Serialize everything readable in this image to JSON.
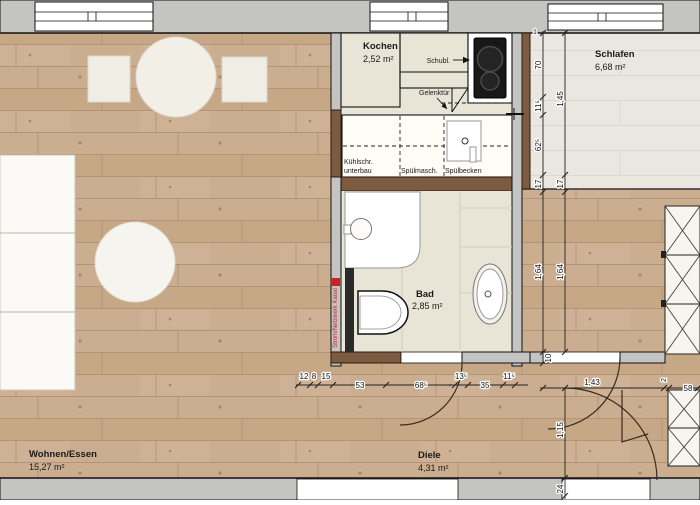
{
  "rooms": {
    "kochen": {
      "name": "Kochen",
      "area": "2,52 m²"
    },
    "schlafen": {
      "name": "Schlafen",
      "area": "6,68 m²"
    },
    "bad": {
      "name": "Bad",
      "area": "2,85 m²"
    },
    "wohnen": {
      "name": "Wohnen/Essen",
      "area": "15,27 m²"
    },
    "diele": {
      "name": "Diele",
      "area": "4,31 m²"
    }
  },
  "kitchen": {
    "schubl": "Schubl.",
    "gelenktuer": "Gelenktür",
    "kuehlschr1": "Kühlschr.",
    "kuehlschr2": "unterbau",
    "spuelmasch": "Spülmasch.",
    "spuelbecken": "Spülbecken"
  },
  "annotations": {
    "kanal": "Strom/Netzwerk Kanal"
  },
  "dims": {
    "bottom": [
      "12",
      "8",
      "15",
      "53",
      "68⁵",
      "13⁵",
      "35",
      "11⁵"
    ],
    "colA": [
      "1",
      "70",
      "11⁵",
      "62⁵",
      "17",
      "1,64",
      "10"
    ],
    "colB": [
      "1,45",
      "17",
      "1,64",
      "1,15",
      "24"
    ],
    "right": [
      "1,43",
      "2",
      "58"
    ]
  },
  "colors": {
    "wood_floor": "#cbad8f",
    "wood_line": "#b59476",
    "light_floor": "#eae7e1",
    "wall_gray": "#c4c4c2",
    "wall_wood": "#7d5b41",
    "floor_beige": "#e8e4d6",
    "accent_red": "#cc2222",
    "cooktop_black": "#181818"
  }
}
